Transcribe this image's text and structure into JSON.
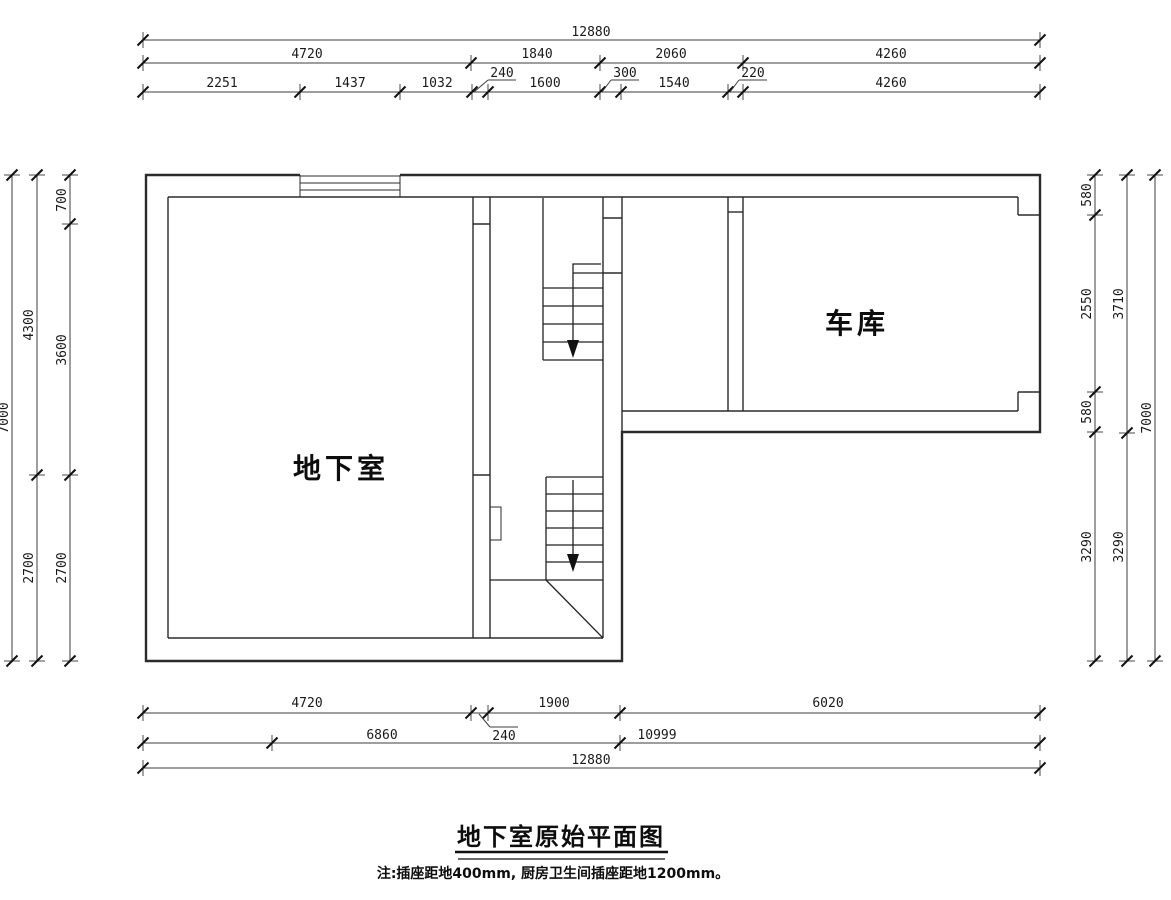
{
  "drawing": {
    "title": "地下室原始平面图",
    "note": "注:插座距地400mm, 厨房卫生间插座距地1200mm。",
    "rooms": {
      "basement": "地下室",
      "garage": "车库"
    }
  },
  "dims": {
    "top1": "12880",
    "top2": [
      "4720",
      "1840",
      "2060",
      "4260"
    ],
    "top3": [
      "2251",
      "1437",
      "1032",
      "1600",
      "1540",
      "4260"
    ],
    "top_leaders": [
      "240",
      "300",
      "220"
    ],
    "bottom1": [
      "4720",
      "1900",
      "6020"
    ],
    "bottom1_leader": "240",
    "bottom2": [
      "6860",
      "10999"
    ],
    "bottom3": "12880",
    "left_outer": "7000",
    "left_mid": [
      "4300",
      "2700"
    ],
    "left_inner": [
      "700",
      "3600",
      "2700"
    ],
    "right_inner": [
      "580",
      "2550",
      "580",
      "3290"
    ],
    "right_mid": [
      "3710",
      "3290"
    ],
    "right_outer": "7000"
  }
}
